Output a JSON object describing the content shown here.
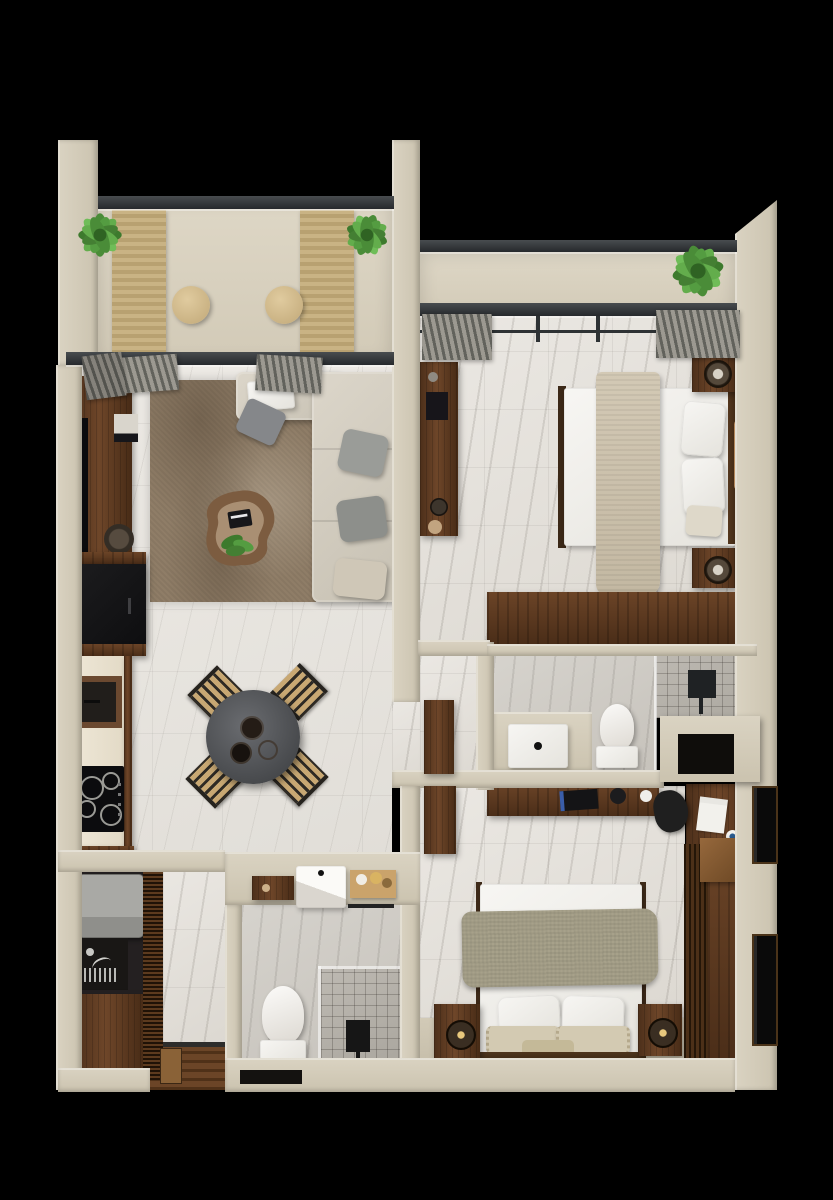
{
  "scene": {
    "description": "Top-down 3D render of a two-bedroom apartment floor plan on a black background",
    "width": 833,
    "height": 1200
  },
  "palette": {
    "bg": "#000000",
    "wall": "#cbc3af",
    "wallLight": "#dad3c2",
    "marble": "#e9e6e1",
    "beam": "#2f3336",
    "walnut": "#5e3c23",
    "walnutDark": "#3a2514",
    "tan": "#c8a873",
    "sofa": "#d5cfc2",
    "rug": "#8d7b66",
    "tile": "#b7b3ad",
    "green": "#4a8c38",
    "sage": "#a7a18a",
    "white": "#f4f3f0",
    "black": "#121212"
  },
  "rooms": [
    {
      "name": "balcony-terrace",
      "furniture": [
        "lounger-mat",
        "lounger-mat",
        "side-stool",
        "side-stool",
        "potted-plant",
        "potted-plant"
      ]
    },
    {
      "name": "living-room",
      "furniture": [
        "l-shaped-sofa",
        "area-rug",
        "coffee-table",
        "tv-console",
        "fireplace-cabinet",
        "curtain"
      ]
    },
    {
      "name": "kitchen",
      "furniture": [
        "refrigerator",
        "sink",
        "cooktop",
        "counter"
      ]
    },
    {
      "name": "dining-area",
      "furniture": [
        "round-table",
        "chair",
        "chair",
        "chair",
        "chair",
        "serving-bowls"
      ]
    },
    {
      "name": "master-bedroom",
      "furniture": [
        "double-bed",
        "throw-blanket",
        "pillows",
        "nightstand",
        "nightstand",
        "wardrobe",
        "wall-console",
        "balcony-plant",
        "curtains"
      ]
    },
    {
      "name": "master-bathroom",
      "furniture": [
        "vanity-sink",
        "toilet",
        "walk-in-shower",
        "storage-niche"
      ]
    },
    {
      "name": "second-bedroom",
      "furniture": [
        "double-bed",
        "sage-blanket",
        "pillows",
        "nightstand",
        "nightstand",
        "desk",
        "desk-chair",
        "wardrobe",
        "shelf"
      ]
    },
    {
      "name": "second-bathroom",
      "furniture": [
        "vanity-sink",
        "toiletry-shelf",
        "switch-panel",
        "toilet",
        "walk-in-shower",
        "towel-bar"
      ]
    },
    {
      "name": "utility-room",
      "furniture": [
        "washer",
        "utility-sink",
        "cabinet"
      ]
    },
    {
      "name": "entry-hall",
      "furniture": [
        "wood-floor",
        "entry-door",
        "slatted-divider"
      ]
    }
  ]
}
